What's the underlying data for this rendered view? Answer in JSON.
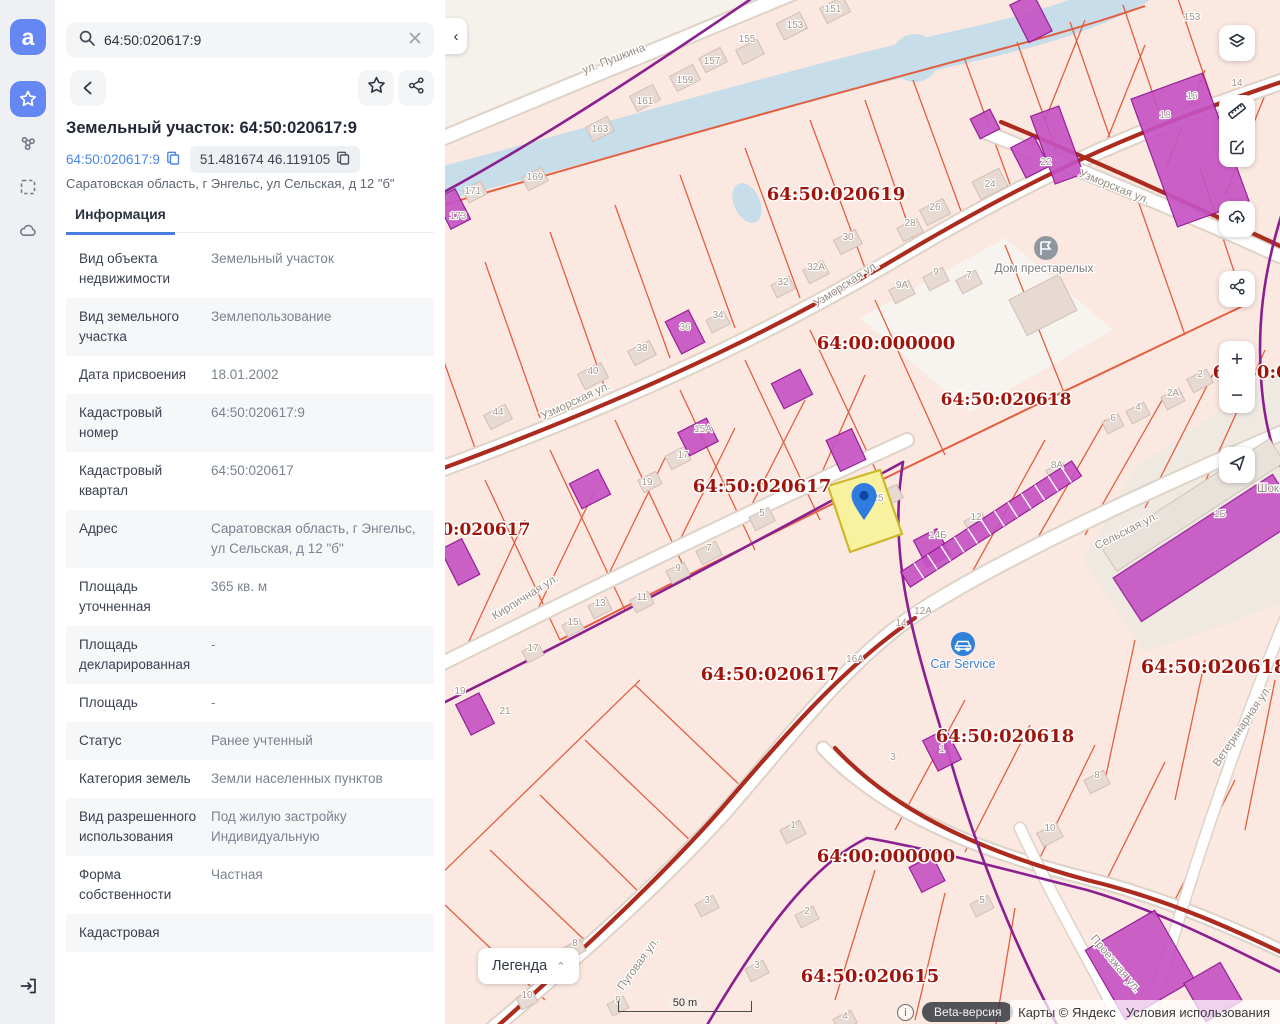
{
  "search": {
    "value": "64:50:020617:9"
  },
  "panel": {
    "title": "Земельный участок: 64:50:020617:9",
    "cad_link": "64:50:020617:9",
    "coords_chip": "51.481674 46.119105",
    "address": "Саратовская область, г Энгельс, ул Сельская, д 12 \"б\"",
    "tab": "Информация",
    "info_rows": [
      {
        "label": "Вид объекта недвижимости",
        "value": "Земельный участок"
      },
      {
        "label": "Вид земельного участка",
        "value": "Землепользование"
      },
      {
        "label": "Дата присвоения",
        "value": "18.01.2002"
      },
      {
        "label": "Кадастровый номер",
        "value": "64:50:020617:9"
      },
      {
        "label": "Кадастровый квартал",
        "value": "64:50:020617"
      },
      {
        "label": "Адрес",
        "value": "Саратовская область, г Энгельс, ул Сельская, д 12 \"б\""
      },
      {
        "label": "Площадь уточненная",
        "value": "365 кв. м"
      },
      {
        "label": "Площадь декларированная",
        "value": "-"
      },
      {
        "label": "Площадь",
        "value": "-"
      },
      {
        "label": "Статус",
        "value": "Ранее учтенный"
      },
      {
        "label": "Категория земель",
        "value": "Земли населенных пунктов"
      },
      {
        "label": "Вид разрешенного использования",
        "value": "Под жилую застройку Индивидуальную"
      },
      {
        "label": "Форма собственности",
        "value": "Частная"
      },
      {
        "label": "Кадастровая",
        "value": ""
      }
    ]
  },
  "map": {
    "legend_button": "Легенда",
    "scale_label": "50 m",
    "beta_badge": "Beta-версия",
    "attribution": "Карты © Яндекс",
    "terms": "Условия использования",
    "poi": {
      "nursing_home": "Дом престарелых",
      "car_service": "Car Service",
      "choco": "Шоко"
    },
    "quarter_labels": [
      {
        "text": "64:50:020619"
      },
      {
        "text": "64:00:000000"
      },
      {
        "text": "64:50:020618"
      },
      {
        "text": "64:50:020617"
      },
      {
        "text": "64:50:020617"
      },
      {
        "text": "64:50:020617"
      },
      {
        "text": "64:50:020618"
      },
      {
        "text": "64:50:020618"
      },
      {
        "text": "64:00:000000"
      },
      {
        "text": "64:50:020615"
      },
      {
        "text": "64:50:020618"
      }
    ],
    "street_labels": [
      {
        "text": "ул. Пушкина"
      },
      {
        "text": "Узморская ул."
      },
      {
        "text": "Узморская ул."
      },
      {
        "text": "Узморская ул."
      },
      {
        "text": "Кирпичная ул."
      },
      {
        "text": "Сельская ул."
      },
      {
        "text": "Ветеринарная ул."
      },
      {
        "text": "Пуговая ул."
      },
      {
        "text": "Проезжая ул."
      }
    ],
    "house_numbers": [
      {
        "t": "151"
      },
      {
        "t": "153"
      },
      {
        "t": "155"
      },
      {
        "t": "157"
      },
      {
        "t": "159"
      },
      {
        "t": "161"
      },
      {
        "t": "163"
      },
      {
        "t": "169"
      },
      {
        "t": "171"
      },
      {
        "t": "173"
      },
      {
        "t": "22"
      },
      {
        "t": "24"
      },
      {
        "t": "26"
      },
      {
        "t": "28"
      },
      {
        "t": "30"
      },
      {
        "t": "32А"
      },
      {
        "t": "32"
      },
      {
        "t": "9А"
      },
      {
        "t": "9"
      },
      {
        "t": "7"
      },
      {
        "t": "14"
      },
      {
        "t": "16"
      },
      {
        "t": "18"
      },
      {
        "t": "153"
      },
      {
        "t": "40"
      },
      {
        "t": "44"
      },
      {
        "t": "38"
      },
      {
        "t": "36"
      },
      {
        "t": "34"
      },
      {
        "t": "19"
      },
      {
        "t": "17"
      },
      {
        "t": "15А"
      },
      {
        "t": "5"
      },
      {
        "t": "7"
      },
      {
        "t": "9"
      },
      {
        "t": "11"
      },
      {
        "t": "13"
      },
      {
        "t": "15"
      },
      {
        "t": "17"
      },
      {
        "t": "19"
      },
      {
        "t": "21"
      },
      {
        "t": "25"
      },
      {
        "t": "2"
      },
      {
        "t": "2А"
      },
      {
        "t": "4"
      },
      {
        "t": "6"
      },
      {
        "t": "8А"
      },
      {
        "t": "12"
      },
      {
        "t": "14Б"
      },
      {
        "t": "12А"
      },
      {
        "t": "14"
      },
      {
        "t": "16А"
      },
      {
        "t": "1Б"
      },
      {
        "t": "8"
      },
      {
        "t": "10"
      },
      {
        "t": "1"
      },
      {
        "t": "2"
      },
      {
        "t": "3"
      },
      {
        "t": "3"
      },
      {
        "t": "5"
      },
      {
        "t": "10"
      },
      {
        "t": "8"
      },
      {
        "t": "9"
      },
      {
        "t": "4"
      },
      {
        "t": "1"
      },
      {
        "t": "3"
      }
    ]
  }
}
